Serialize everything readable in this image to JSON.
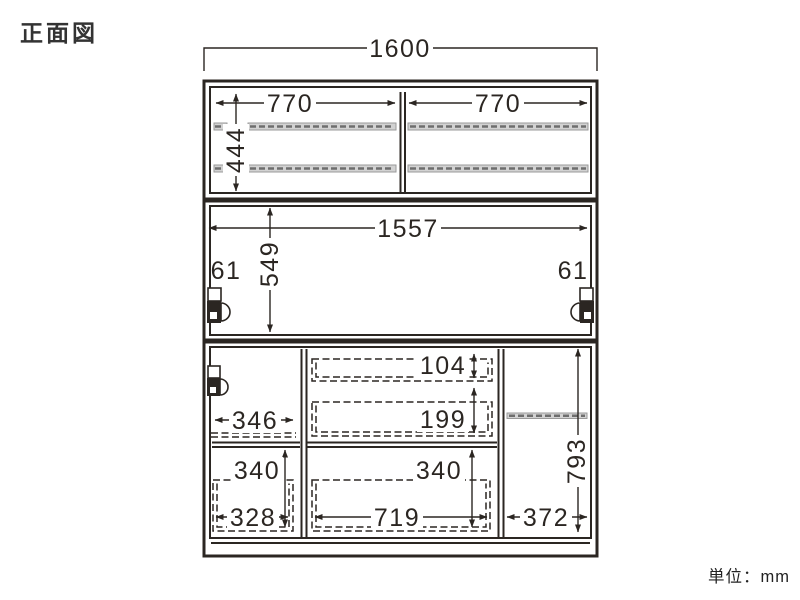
{
  "title": "正面図",
  "unit_note": "単位：mm",
  "drawing": {
    "overall_width": "1600",
    "top_section": {
      "left_opening_width": "770",
      "right_opening_width": "770",
      "inner_height": "444"
    },
    "middle_section": {
      "inner_width": "1557",
      "inner_height": "549",
      "left_side_gap": "61",
      "right_side_gap": "61"
    },
    "bottom_section": {
      "upper_drawer_inner_height": "104",
      "lower_drawer_inner_height": "199",
      "left_compartment_width": "346",
      "left_drawer_height": "340",
      "left_drawer_inner_width": "328",
      "center_drawer_height": "340",
      "center_drawer_inner_width": "719",
      "right_compartment_width": "372",
      "right_compartment_height": "793"
    }
  },
  "colors": {
    "line": "#2b2622",
    "shelf_fill": "#d2d2d2",
    "shelf_dash": "#6e6e6e",
    "text": "#2b2622"
  }
}
